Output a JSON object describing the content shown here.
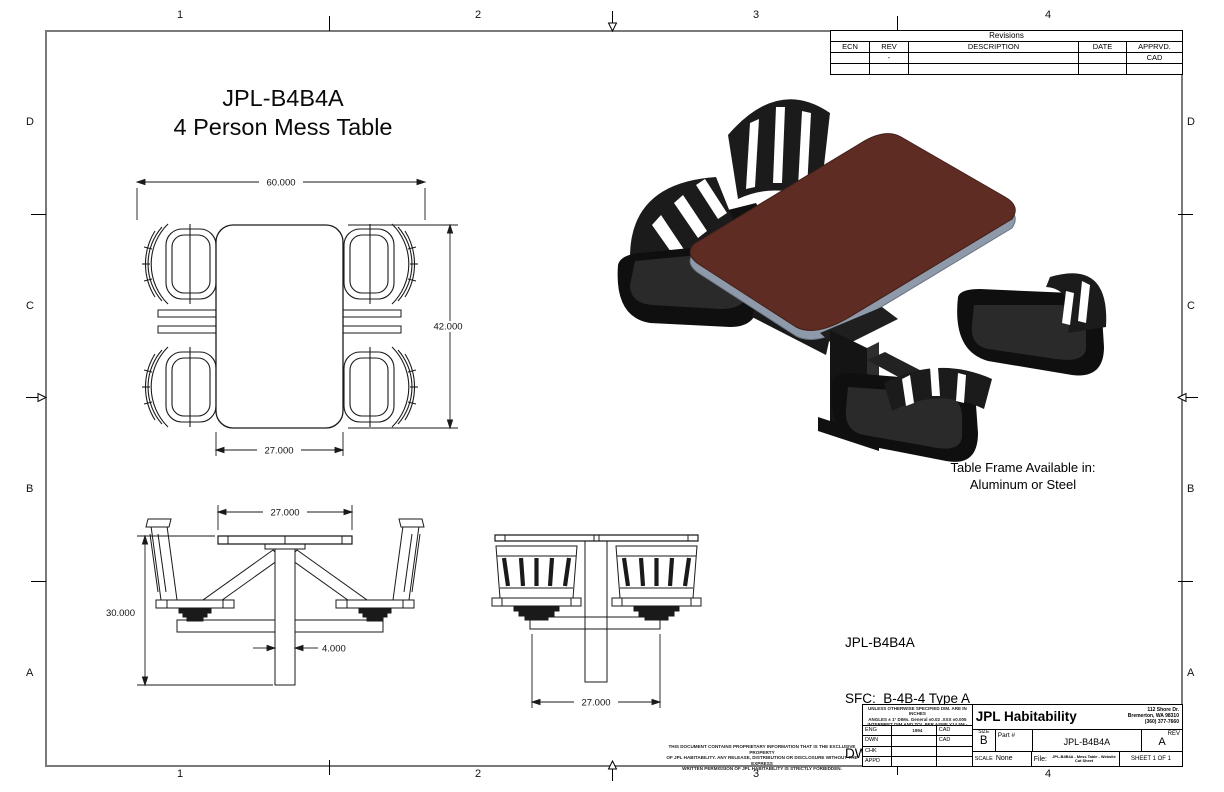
{
  "sheet": {
    "title": [
      "JPL-B4B4A",
      "4 Person Mess Table"
    ],
    "frame_note": [
      "Table Frame Available in:",
      "Aluminum or Steel"
    ],
    "part_info": [
      "JPL-B4B4A",
      "SFC:  B-4B-4 Type A",
      "DWG:  612-4833273"
    ],
    "zones": {
      "cols": [
        "1",
        "2",
        "3",
        "4"
      ],
      "rows": [
        "D",
        "C",
        "B",
        "A"
      ]
    }
  },
  "dims": {
    "plan_overall_width": "60.000",
    "plan_depth": "42.000",
    "plan_tabletop_width": "27.000",
    "front_tabletop_width": "27.000",
    "overall_height": "30.000",
    "pedestal_width": "4.000",
    "side_seat_spacing": "27.000"
  },
  "revisions": {
    "title": "Revisions",
    "columns": [
      "ECN",
      "REV",
      "DESCRIPTION",
      "DATE",
      "APPRVD."
    ],
    "rows": [
      [
        "",
        "-",
        "",
        "",
        "CAD"
      ],
      [
        "",
        "",
        "",
        "",
        ""
      ]
    ]
  },
  "title_block": {
    "tolerance_notes": [
      "UNLESS OTHERWISE SPECIFIED DIM. ARE IN INCHES",
      "ANGLES ± 1°   DIMs. General ±0.02   .XXX ±0.005",
      "INTERPRET DIM AND TOL PER ASME Y14.5M - 1994"
    ],
    "approvals": [
      {
        "label": "ENG",
        "name": "",
        "by": "CAD"
      },
      {
        "label": "DWN",
        "name": "",
        "by": "CAD"
      },
      {
        "label": "CHK",
        "name": "",
        "by": ""
      },
      {
        "label": "APPD",
        "name": "",
        "by": ""
      }
    ],
    "company": "JPL Habitability",
    "address": [
      "112 Shore Dr.",
      "Bremerton, WA 98310",
      "(360) 377-7660"
    ],
    "size_label": "SIZE",
    "size": "B",
    "part_label": "Part #",
    "part_number": "JPL-B4B4A",
    "rev_label": "REV",
    "rev": "A",
    "scale_label": "SCALE",
    "scale": "None",
    "file_label": "File:",
    "file_value": "JPL-B4B4A - Mess Table - Website Cut Sheet",
    "sheet_label": "SHEET 1 OF 1"
  },
  "proprietary_notice": [
    "THIS DOCUMENT CONTAINS PROPRIETARY INFORMATION THAT IS THE EXCLUSIVE PROPERTY",
    "OF JPL HABITABILITY. ANY RELEASE, DISTRIBUTION OR DISCLOSURE WITHOUT THE EXPRESS",
    "WRITTEN PERMISSION OF JPL HABITABILITY IS STRICTLY FORBIDDEN."
  ],
  "colors": {
    "table_top": "#5e2c23",
    "table_edge": "#8e9aa9",
    "chair_black": "#1b1b1b",
    "border_gray": "#7a7a7a"
  }
}
